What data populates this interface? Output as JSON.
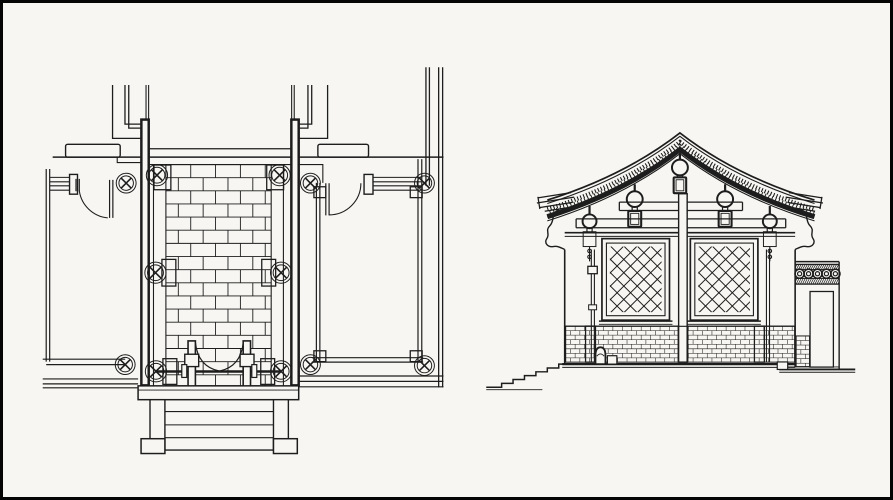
{
  "colors": {
    "paper": "#f7f6f2",
    "ink": "#1d1d1d",
    "joint": "#6e6e6e",
    "dado_joint": "#4a4a4a",
    "paving_fill": "#f3f1ea",
    "dado_fill": "#e9e7df",
    "window_fill": "#f4f3ee",
    "lattice": "#3c3c3c",
    "hatch_bg": "#dcdad2",
    "stipple": "#8d8d8d",
    "stipple2": "#6d6d6d",
    "dark_band": "#151515",
    "border": "#000000",
    "white": "#ffffff"
  },
  "panels": {
    "left": "floor-plan",
    "right": "side-elevation"
  },
  "plan": {
    "columns": [
      {
        "x": 124,
        "y": 182.3,
        "r": 7.3
      },
      {
        "x": 155,
        "y": 174.3,
        "r": 8
      },
      {
        "x": 278.5,
        "y": 174.3,
        "r": 8
      },
      {
        "x": 309.5,
        "y": 182.3,
        "r": 7.3
      },
      {
        "x": 424.3,
        "y": 182.3,
        "r": 7.3
      },
      {
        "x": 153.5,
        "y": 273,
        "r": 8
      },
      {
        "x": 280,
        "y": 273,
        "r": 8
      },
      {
        "x": 123,
        "y": 366,
        "r": 7.3
      },
      {
        "x": 154,
        "y": 372.8,
        "r": 8
      },
      {
        "x": 280,
        "y": 372.8,
        "r": 8
      },
      {
        "x": 309.5,
        "y": 366,
        "r": 7.3
      },
      {
        "x": 424.3,
        "y": 367,
        "r": 7.3
      }
    ],
    "pads": [
      {
        "x": 152,
        "y": 164,
        "w": 17,
        "h": 25
      },
      {
        "x": 265.5,
        "y": 164,
        "w": 17,
        "h": 25
      },
      {
        "x": 160,
        "y": 259.5,
        "w": 14,
        "h": 27
      },
      {
        "x": 260.5,
        "y": 259.5,
        "w": 14,
        "h": 27
      },
      {
        "x": 161,
        "y": 360,
        "w": 14,
        "h": 26
      },
      {
        "x": 259.5,
        "y": 360,
        "w": 14,
        "h": 26
      },
      {
        "x": 313,
        "y": 186,
        "w": 12,
        "h": 11
      },
      {
        "x": 410,
        "y": 186,
        "w": 12,
        "h": 11
      },
      {
        "x": 313,
        "y": 352,
        "w": 12,
        "h": 11
      },
      {
        "x": 410,
        "y": 352,
        "w": 12,
        "h": 11
      }
    ],
    "paving": {
      "x": 164,
      "y": 163.5,
      "w": 106,
      "h": 224,
      "row_h": 13.3,
      "brick_w": 25
    }
  },
  "elevation": {
    "windows": [
      {
        "x": 603,
        "y": 238.5,
        "w": 68,
        "h": 82.5
      },
      {
        "x": 692,
        "y": 238.5,
        "w": 68,
        "h": 82.5
      }
    ],
    "lattice": {
      "spacing": 13.5,
      "frame_inset": 4.5,
      "grid_inset": 8
    },
    "dado": {
      "row_h": 4.6,
      "brick_w": 9.5,
      "regions": [
        {
          "x": 566.5,
          "y": 327,
          "w": 230.5,
          "h": 36.5
        },
        {
          "x": 798.5,
          "y": 337,
          "w": 13.5,
          "h": 31
        }
      ],
      "pilasters": [
        {
          "x": 586.5,
          "y": 327,
          "w": 10,
          "h": 36.5
        },
        {
          "x": 679.8,
          "y": 327,
          "w": 9.6,
          "h": 36.5
        },
        {
          "x": 756.5,
          "y": 327,
          "w": 10,
          "h": 36.5
        }
      ]
    },
    "rings": {
      "count": 5,
      "x0": 802,
      "step": 9,
      "cy": 274,
      "r": 4.6,
      "r_inner": 2.1
    },
    "hatch_bands": [
      {
        "x": 797.5,
        "y": 264.9,
        "w": 44.3,
        "h": 4.8
      },
      {
        "x": 797.5,
        "y": 279,
        "w": 44.3,
        "h": 5.2
      }
    ],
    "hangers": [
      {
        "x": 681.5,
        "stem_y1": 151.5,
        "stem_y2": 158.5,
        "cy": 166.5,
        "r": 8,
        "pend": {
          "y": 176.5,
          "w": 12.6,
          "h": 16
        },
        "style": "outline"
      },
      {
        "x": 636,
        "stem_y1": 183.5,
        "stem_y2": 190.5,
        "cy": 198.5,
        "r": 8,
        "pend": {
          "y": 210.5,
          "w": 13,
          "h": 16
        },
        "style": "outline"
      },
      {
        "x": 727,
        "stem_y1": 183.5,
        "stem_y2": 190.5,
        "cy": 198.5,
        "r": 8,
        "pend": {
          "y": 210.5,
          "w": 13,
          "h": 16
        },
        "style": "outline"
      },
      {
        "x": 590.5,
        "stem_y1": 205.5,
        "stem_y2": 214,
        "cy": 221,
        "r": 7,
        "pend": {
          "y": 231.5,
          "w": 12.8,
          "h": 15
        },
        "style": "black",
        "tail": true
      },
      {
        "x": 772,
        "stem_y1": 205.5,
        "stem_y2": 214,
        "cy": 221,
        "r": 7,
        "pend": {
          "y": 231.5,
          "w": 12.8,
          "h": 15
        },
        "style": "black",
        "tail": true
      }
    ]
  }
}
